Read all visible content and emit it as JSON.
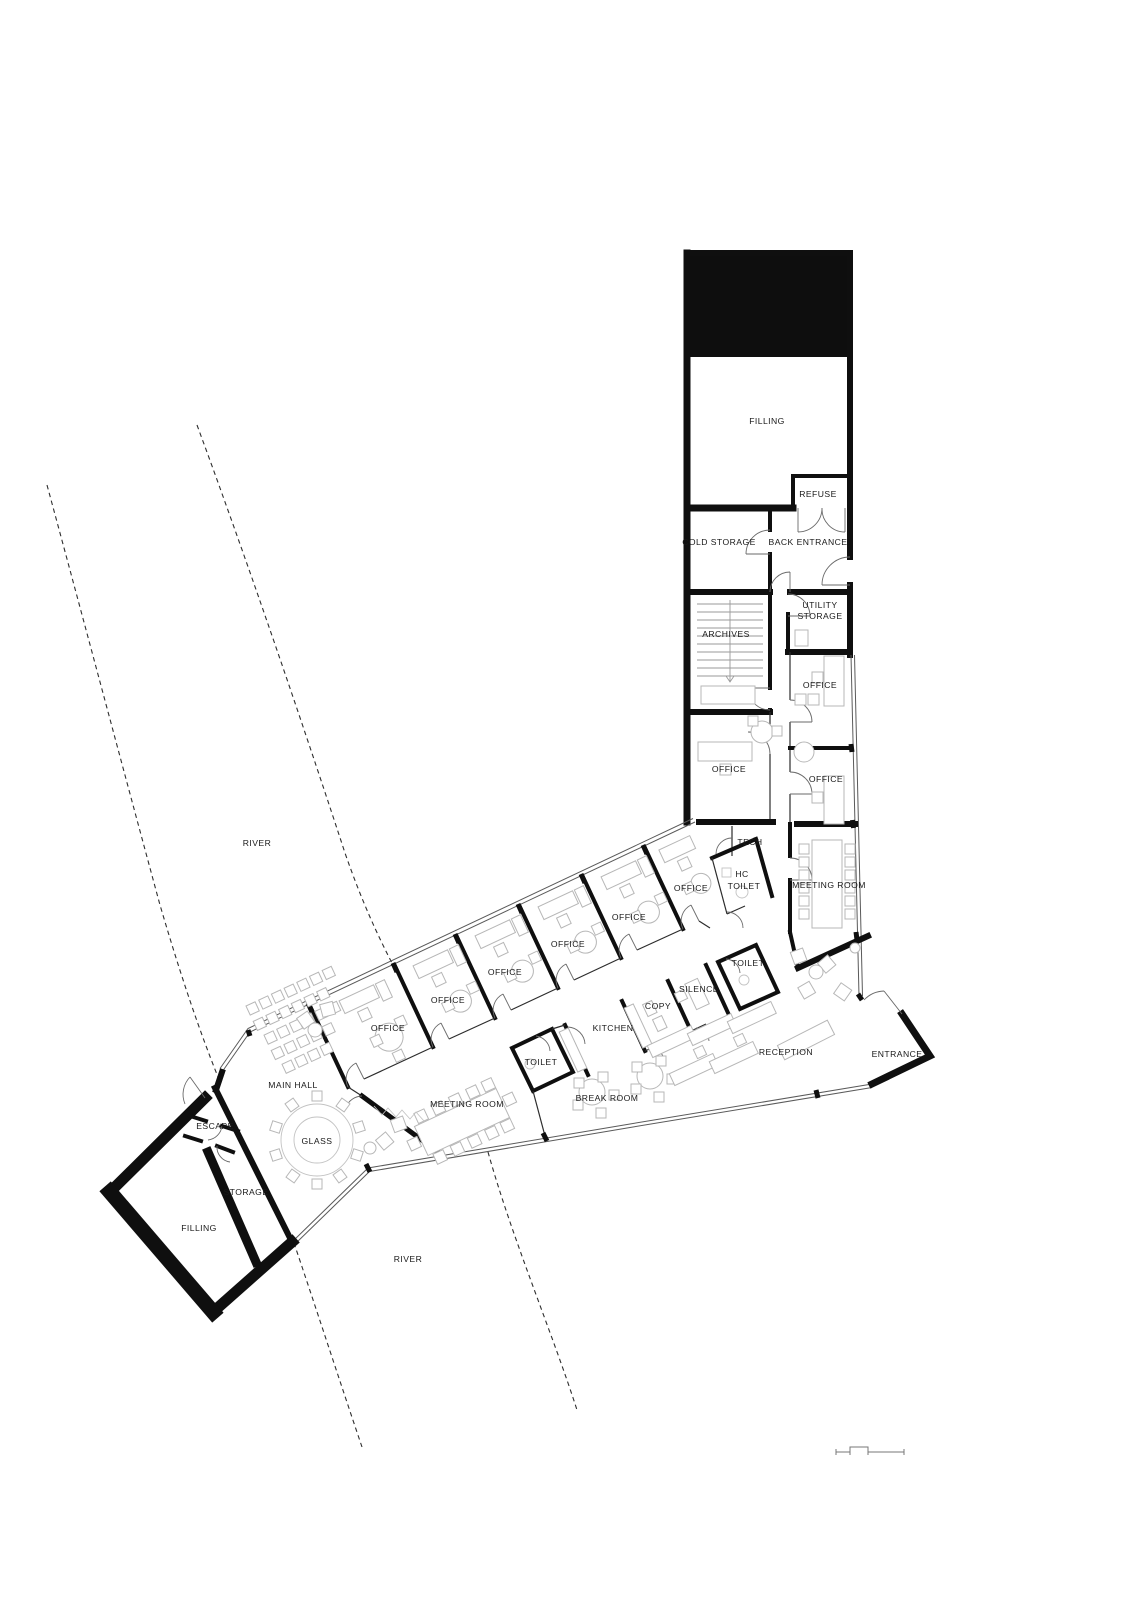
{
  "plan": {
    "rooms": {
      "filling": "FILLING",
      "refuse": "REFUSE",
      "cold_storage": "COLD STORAGE",
      "back_entrance": "BACK ENTRANCE",
      "archives": "ARCHIVES",
      "utility_1": "UTILITY",
      "storage": "STORAGE",
      "office": "OFFICE",
      "tech": "TECH",
      "hc_1": "HC",
      "toilet": "TOILET",
      "meeting_room": "MEETING ROOM",
      "kitchen": "KITCHEN",
      "copy": "COPY",
      "silence": "SILENCE",
      "reception": "RECEPTION",
      "entrance": "ENTRANCE",
      "break_room": "BREAK ROOM",
      "main_hall": "MAIN HALL",
      "glass": "GLASS",
      "escape": "ESCAPE",
      "river": "RIVER"
    },
    "colors": {
      "wall": "#0f0f0f",
      "solid_fill": "#0e0e0e",
      "furniture": "#b7b7b7",
      "paper": "#ffffff"
    }
  }
}
